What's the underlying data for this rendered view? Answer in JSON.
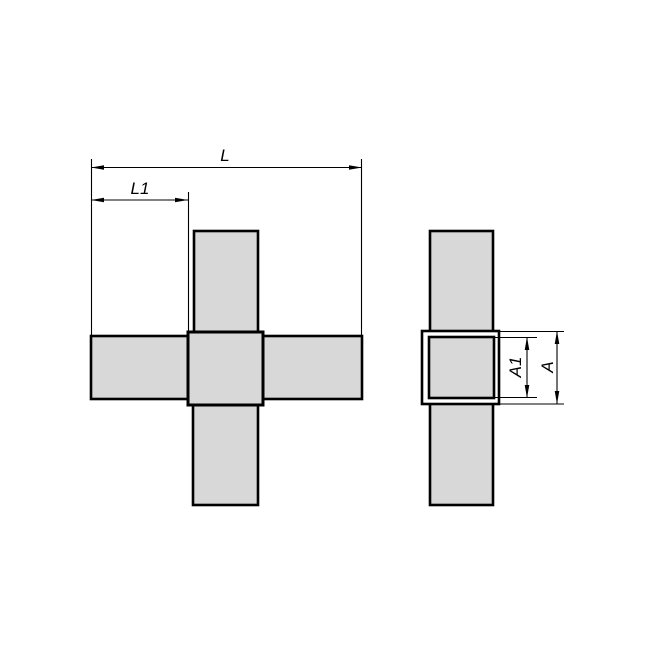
{
  "page": {
    "background": "#ffffff"
  },
  "drawing": {
    "kind": "technical-drawing-two-views",
    "subject": "cross-tube-connector",
    "colors": {
      "part_fill": "#d8d8d8",
      "hub_gap_fill": "#ffffff",
      "line": "#000000"
    },
    "views": [
      {
        "id": "front-view",
        "parts": [
          "top-tube",
          "left-tube",
          "right-tube",
          "bottom-tube",
          "center-hub"
        ]
      },
      {
        "id": "side-view",
        "parts": [
          "vertical-tube",
          "hub-outer-square",
          "hub-inner-square"
        ]
      }
    ],
    "dimensions": {
      "L": {
        "label": "L",
        "orientation": "horizontal"
      },
      "L1": {
        "label": "L1",
        "orientation": "horizontal"
      },
      "A1": {
        "label": "A1",
        "orientation": "vertical"
      },
      "A": {
        "label": "A",
        "orientation": "vertical"
      }
    }
  }
}
